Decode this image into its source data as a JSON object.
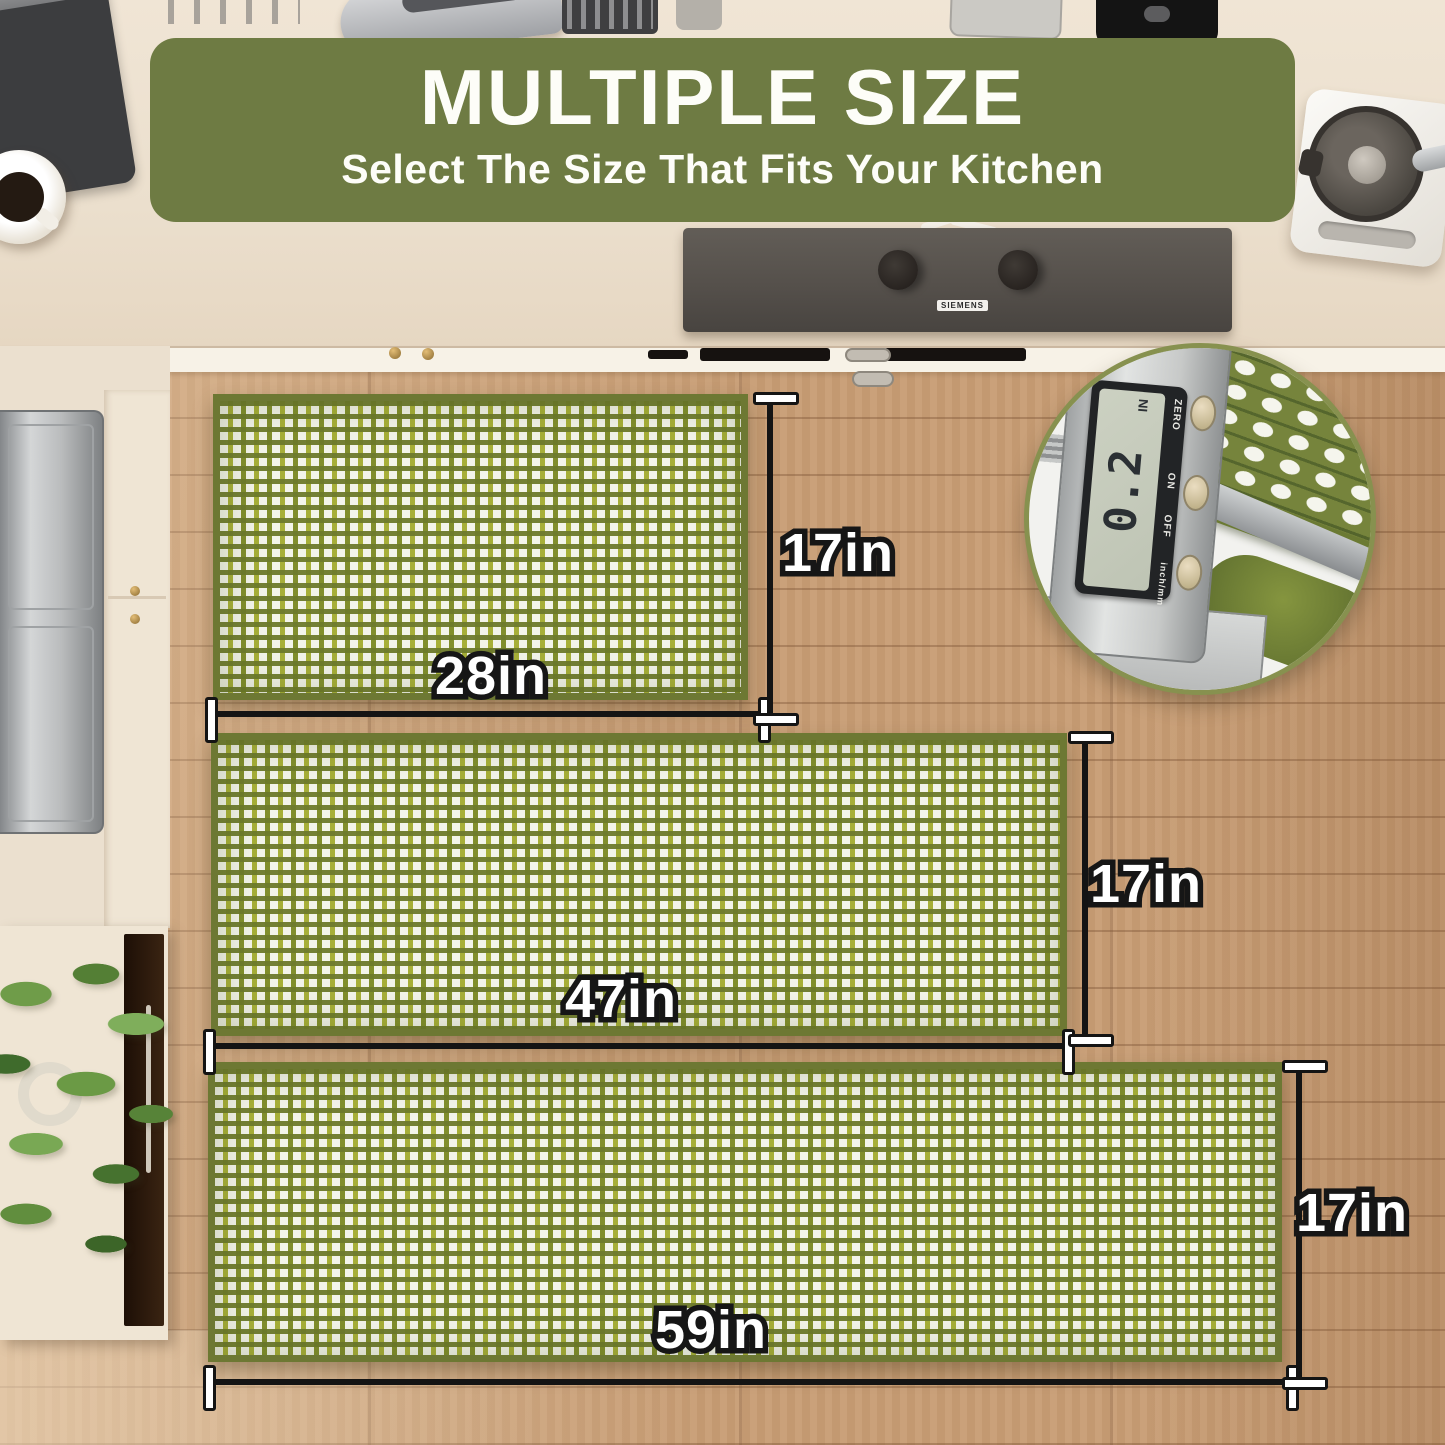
{
  "banner": {
    "title": "MULTIPLE SIZE",
    "subtitle": "Select The Size That Fits Your Kitchen"
  },
  "mats": [
    {
      "name": "small-mat",
      "width_label": "28in",
      "height_label": "17in"
    },
    {
      "name": "medium-runner-mat",
      "width_label": "47in",
      "height_label": "17in"
    },
    {
      "name": "long-runner-mat",
      "width_label": "59in",
      "height_label": "17in"
    }
  ],
  "inset": {
    "display_value": "0.2",
    "display_unit": "IN",
    "buttons": [
      "ZERO",
      "ON",
      "OFF"
    ],
    "mode_label": "inch/mm"
  },
  "cooktop": {
    "brand": "SIEMENS"
  },
  "colors": {
    "banner_green": "#6e7b43",
    "mat_green": "#93a02f",
    "mat_border": "#6d7833",
    "floor_wood": "#c79c73",
    "counter_cream": "#ebe0cf"
  }
}
